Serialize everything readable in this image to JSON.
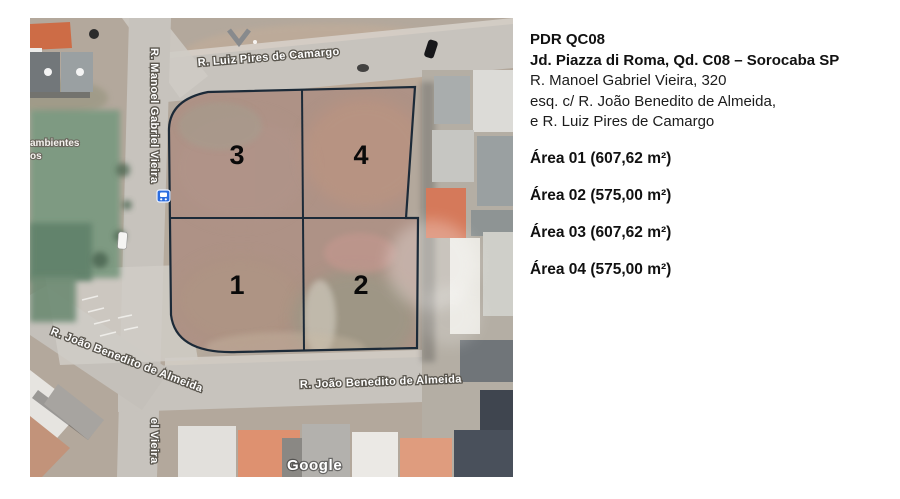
{
  "panel": {
    "title": "PDR QC08",
    "subtitle": "Jd. Piazza di Roma, Qd. C08 – Sorocaba SP",
    "address": [
      "R. Manoel Gabriel Vieira, 320",
      "esq. c/ R. João Benedito de Almeida,",
      "e R. Luiz Pires de Camargo"
    ],
    "areas": [
      "Área 01 (607,62 m²)",
      "Área 02 (575,00 m²)",
      "Área 03 (607,62 m²)",
      "Área 04 (575,00 m²)"
    ]
  },
  "map": {
    "streets": {
      "top": "R. Luiz Pires de Camargo",
      "left_vertical": "R. Manoel Gabriel Vieira",
      "left_vertical_partial": "el Vieira",
      "bottom_diagonal": "R. João Benedito de Almeida",
      "bottom_horizontal": "R. João Benedito de Almeida"
    },
    "neighbor_label": {
      "line1": "ambientes",
      "line2": "os"
    },
    "lot_numbers": {
      "top_left": "3",
      "top_right": "4",
      "bottom_left": "1",
      "bottom_right": "2"
    },
    "watermark": "Google",
    "icons": {
      "bus_stop": "bus-stop-icon",
      "arrow_marker": "down-arrow-marker-icon"
    },
    "colors": {
      "lot_outline": "#1c2a38",
      "bus_icon_blue": "#2a6cdf",
      "road_gray": "#c7c3bd",
      "grass_green": "#7c9a81",
      "dirt_tan": "#ae9286"
    }
  }
}
